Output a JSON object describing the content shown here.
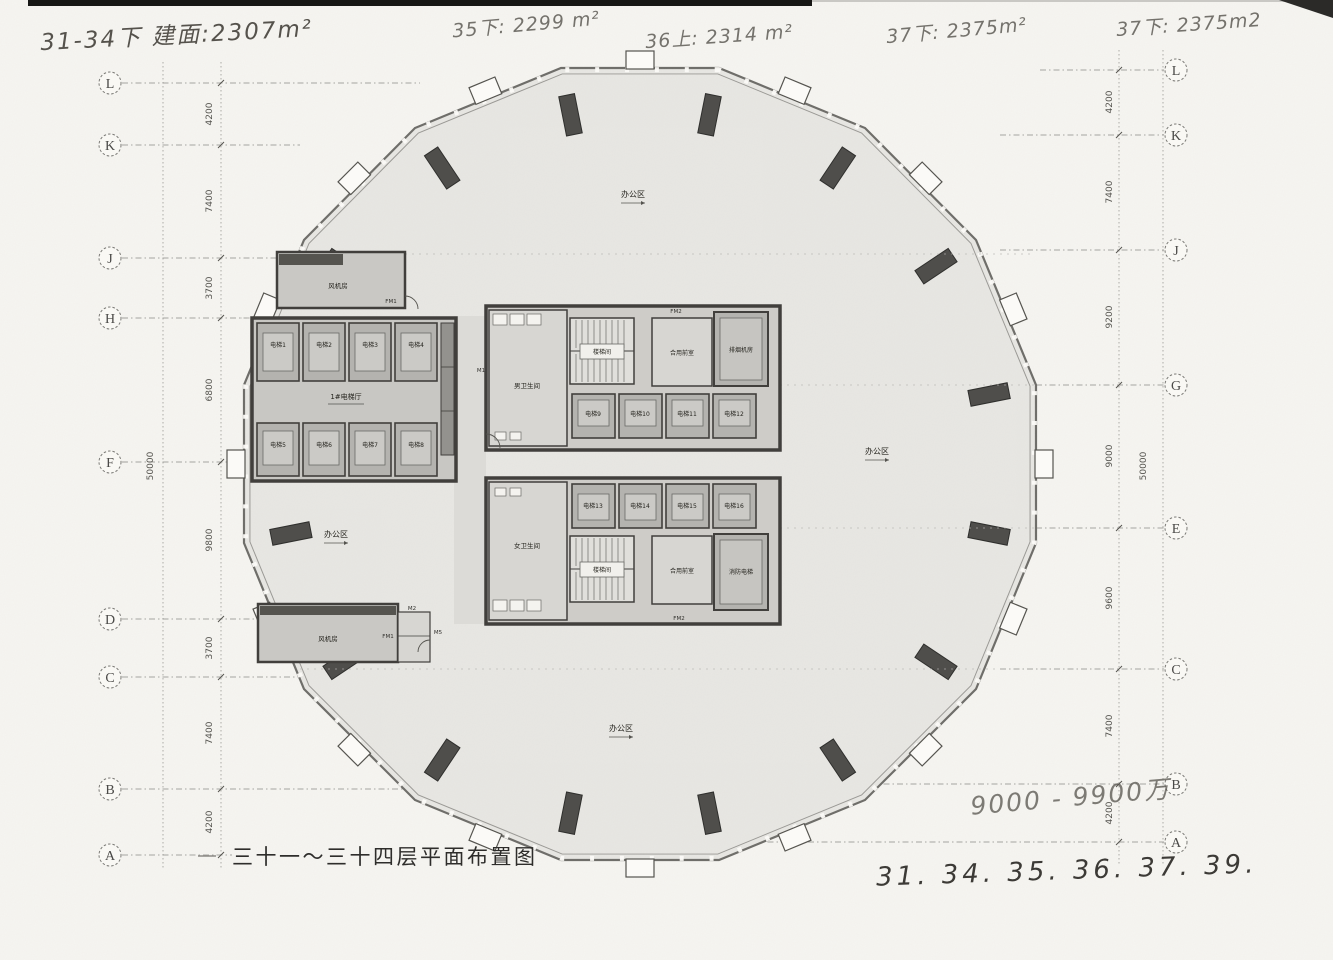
{
  "annotations": {
    "top_left": "31-34下 建面:2307m²",
    "note_35": "35下: 2299 m²",
    "note_36": "36上: 2314 m²",
    "note_37a": "37下: 2375m²",
    "note_37b": "37下: 2375m2",
    "price_range": "9000 - 9900万",
    "floor_list": "31. 34. 35. 36. 37. 39."
  },
  "title": "三十一～三十四层平面布置图",
  "grid_left": {
    "labels": [
      "L",
      "K",
      "J",
      "H",
      "F",
      "D",
      "C",
      "B",
      "A"
    ],
    "dims": [
      "4200",
      "7400",
      "3700",
      "6800",
      "9800",
      "3700",
      "7400",
      "4200"
    ],
    "total": "50000"
  },
  "grid_right": {
    "labels": [
      "L",
      "K",
      "J",
      "G",
      "E",
      "C",
      "B",
      "A"
    ],
    "dims": [
      "4200",
      "7400",
      "9200",
      "9000",
      "9600",
      "7400",
      "4200"
    ],
    "total": "50000"
  },
  "plan": {
    "office_area": "办公区",
    "fan_room": "风机房",
    "elevator_hall": "1#电梯厅",
    "stair": "楼梯间",
    "mens_wc": "男卫生间",
    "womens_wc": "女卫生间",
    "vestibule": "合用前室",
    "smoke_room": "排烟机房",
    "fire_elevator": "消防电梯",
    "elevators": [
      "电梯1",
      "电梯2",
      "电梯3",
      "电梯4",
      "电梯5",
      "电梯6",
      "电梯7",
      "电梯8",
      "电梯9",
      "电梯10",
      "电梯11",
      "电梯12",
      "电梯13",
      "电梯14",
      "电梯15",
      "电梯16"
    ],
    "doors": {
      "fm1": "FM1",
      "fm2": "FM2",
      "m1": "M1",
      "m2": "M2",
      "m5": "M5"
    }
  },
  "colors": {
    "wall": "#413f3c",
    "floor": "#e9e8e4",
    "paper": "#f6f5f1",
    "pier": "#4f4e4b"
  }
}
